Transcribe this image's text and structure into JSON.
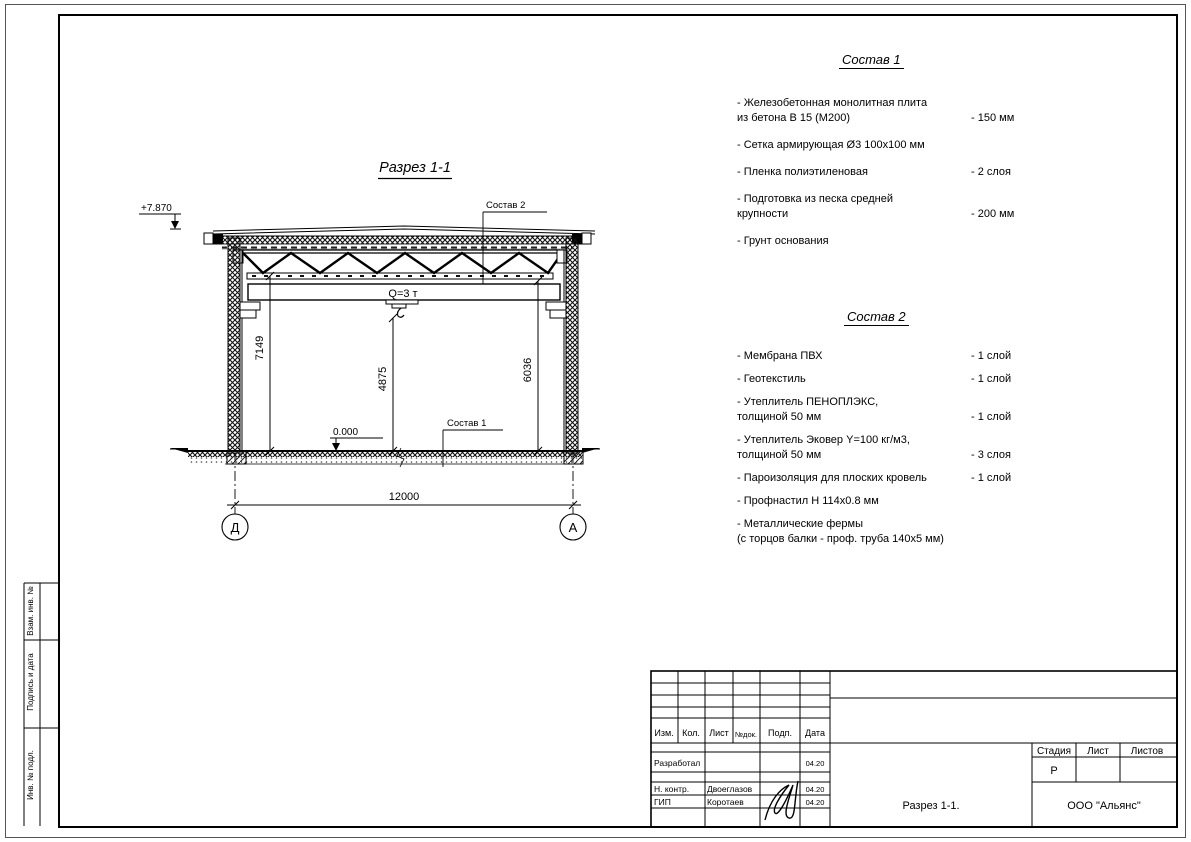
{
  "sheet": {
    "background": "#ffffff",
    "line_color": "#000000"
  },
  "drawing": {
    "title": "Разрез 1-1",
    "elevation_top": "+7.870",
    "elevation_zero": "0.000",
    "crane_capacity": "Q=3 т",
    "dim_height_left": "7149",
    "dim_height_center": "4875",
    "dim_height_right": "6036",
    "dim_span": "12000",
    "axis_left": "Д",
    "axis_right": "А",
    "leader_comp2": "Состав 2",
    "leader_comp1": "Состав 1"
  },
  "comp1": {
    "title": "Состав 1",
    "items": [
      {
        "name": "- Железобетонная монолитная плита\nиз бетона В 15 (М200)",
        "value": "- 150 мм"
      },
      {
        "name": "- Сетка армирующая Ø3 100х100 мм",
        "value": ""
      },
      {
        "name": "- Пленка полиэтиленовая",
        "value": "- 2 слоя"
      },
      {
        "name": "- Подготовка из песка средней\nкрупности",
        "value": "- 200 мм"
      },
      {
        "name": "- Грунт основания",
        "value": ""
      }
    ]
  },
  "comp2": {
    "title": "Состав 2",
    "items": [
      {
        "name": "- Мембрана ПВХ",
        "value": "- 1 слой"
      },
      {
        "name": "- Геотекстиль",
        "value": "- 1 слой"
      },
      {
        "name": "- Утеплитель ПЕНОПЛЭКС,\nтолщиной 50 мм",
        "value": "- 1 слой"
      },
      {
        "name": "- Утеплитель Эковер Y=100 кг/м3,\nтолщиной 50 мм",
        "value": "- 3 слоя"
      },
      {
        "name": "- Пароизоляция для плоских кровель",
        "value": "- 1 слой"
      },
      {
        "name": "- Профнастил Н 114х0.8 мм",
        "value": ""
      },
      {
        "name": "- Металлические фермы\n(с торцов балки - проф. труба 140х5 мм)",
        "value": ""
      }
    ]
  },
  "titleblock": {
    "headers": {
      "izm": "Изм.",
      "kol": "Кол.",
      "list": "Лист",
      "ndok": "№док.",
      "podp": "Подп.",
      "data": "Дата"
    },
    "rows": [
      {
        "role": "Разработал",
        "name": "",
        "date": "04.20"
      },
      {
        "role": "Н. контр.",
        "name": "Двоеглазов",
        "date": "04.20"
      },
      {
        "role": "ГИП",
        "name": "Коротаев",
        "date": "04.20"
      }
    ],
    "stage_label": "Стадия",
    "sheet_label": "Лист",
    "sheets_label": "Листов",
    "stage_value": "Р",
    "doc_title": "Разрез 1-1.",
    "company": "ООО \"Альянс\""
  },
  "side_strip": {
    "cells": [
      "Взам. инв. №",
      "Подпись и дата",
      "Инв. № подл."
    ]
  }
}
